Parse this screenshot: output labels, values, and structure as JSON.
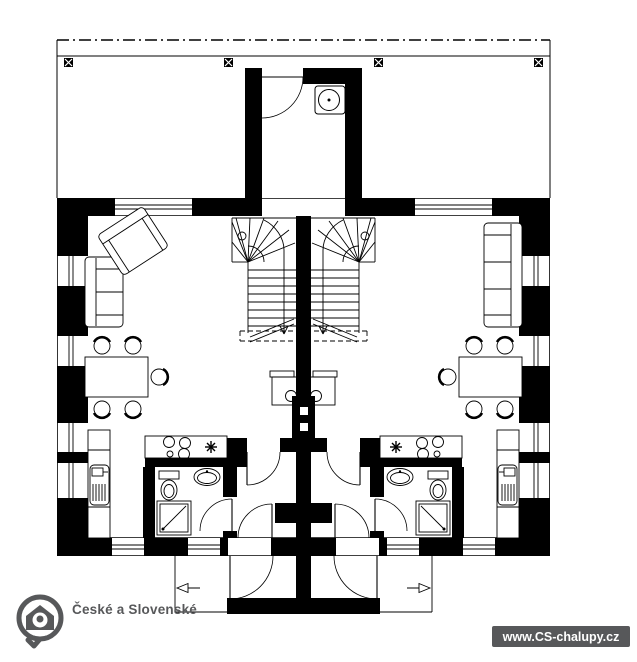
{
  "branding": {
    "logo_text": "České a Slovenské",
    "logo_icon": "house-location-pin-icon",
    "website_badge": "www.CS-chalupy.cz"
  },
  "colors": {
    "walls": "#000000",
    "background": "#ffffff",
    "brand_gray": "#57585a",
    "badge_text": "#ffffff"
  },
  "floor_plan": {
    "kind": "ground-floor plan of semi-detached cottage, two mirrored units",
    "shared_elements": [
      "terrace-with-columns",
      "entry-porch-room-with-washbasin",
      "party-wall-with-chimney-flues",
      "entrance-porch"
    ],
    "unit_fixtures": [
      "winder-staircase",
      "fireplace-stove",
      "dining-table",
      "chairs",
      "kitchen-counter",
      "cooktop",
      "water-heater-symbol",
      "kitchen-sink",
      "toilet",
      "washbasin",
      "shower",
      "door-swings",
      "windows"
    ],
    "left_unit_extra": [
      "two-seat-sofa",
      "armchair"
    ],
    "right_unit_extra": [
      "three-seat-sofa"
    ]
  }
}
